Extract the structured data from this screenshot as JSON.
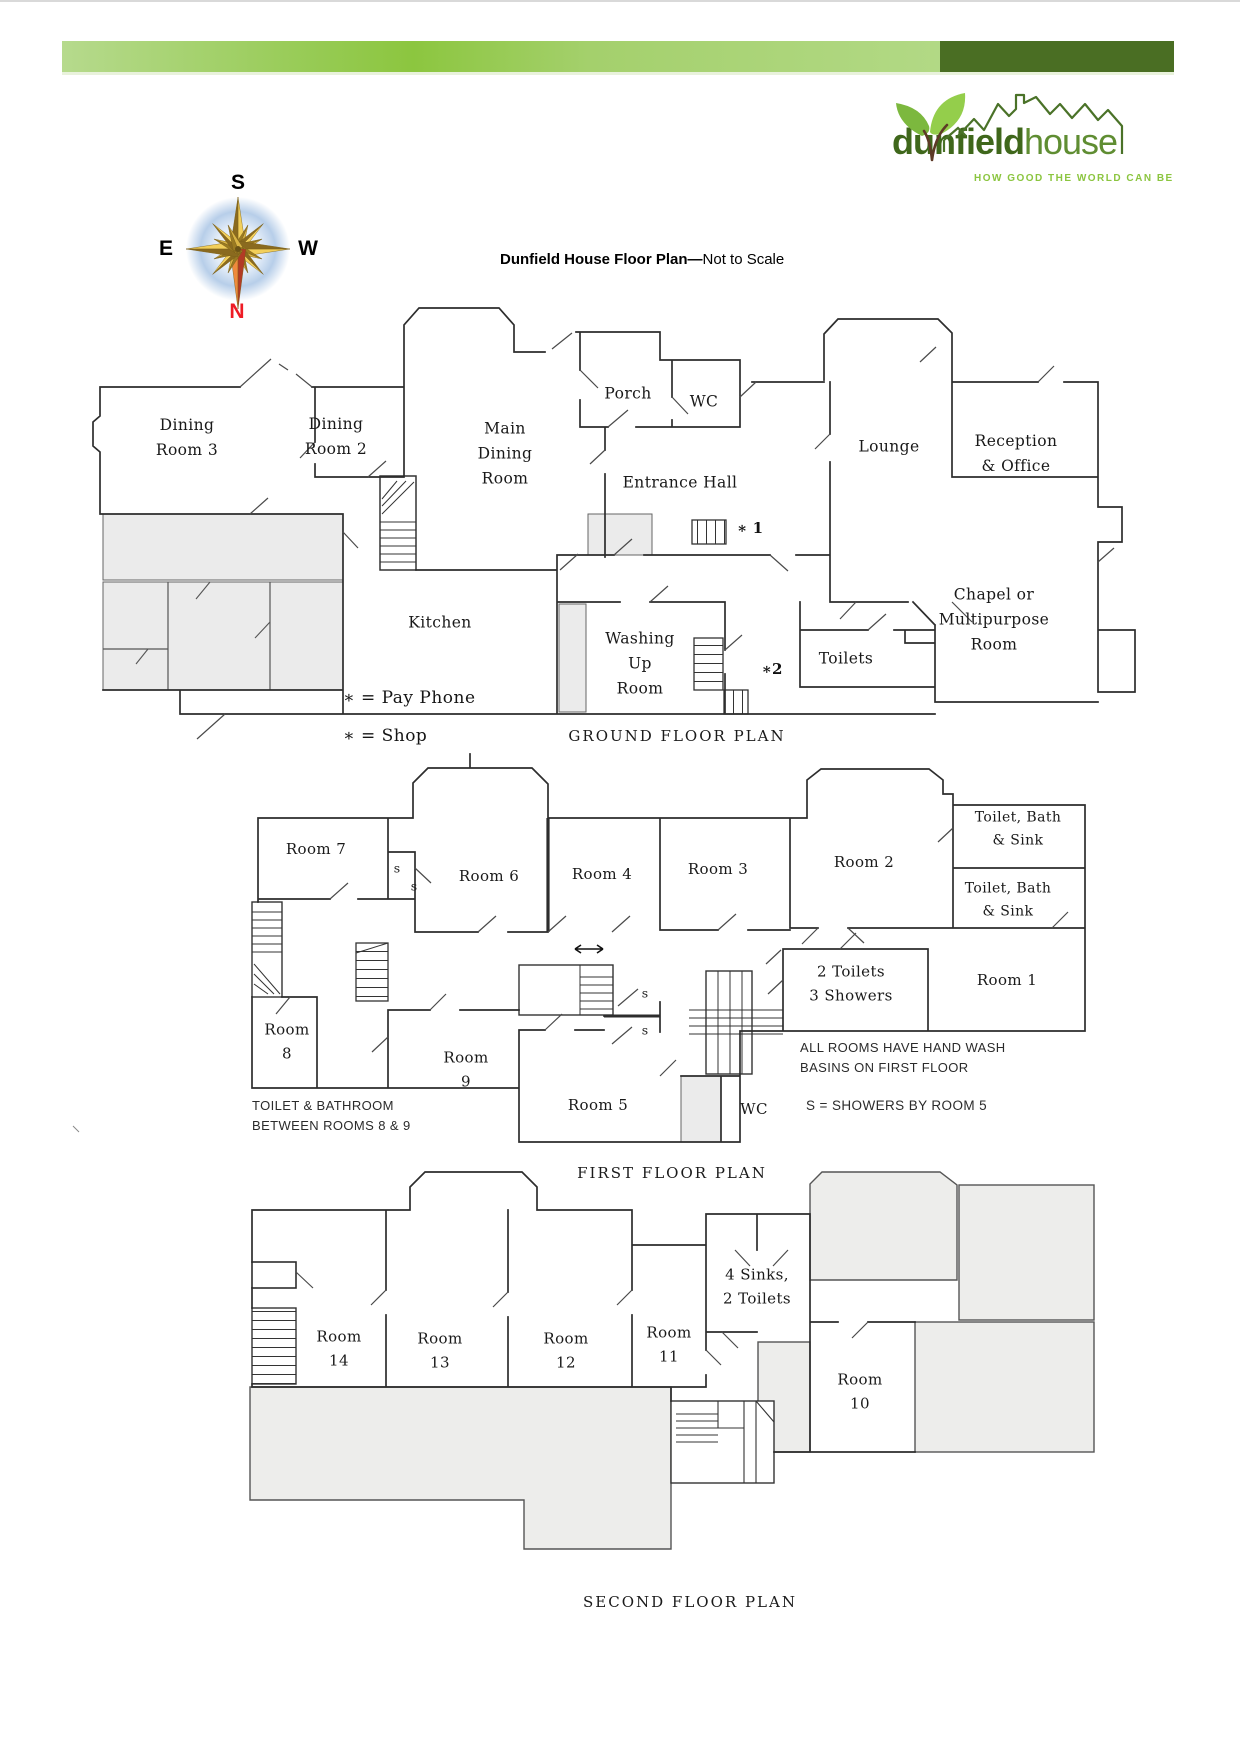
{
  "colors": {
    "accent_light": "#b6da8d",
    "accent_mid": "#8cc63f",
    "accent_dark": "#4a6e23",
    "north_red": "#ee1c25",
    "compass_gold": "#e3b53a"
  },
  "title": {
    "bold": "Dunfield House Floor Plan",
    "separator": "—",
    "regular": "Not to Scale"
  },
  "logo": {
    "brand_bold": "dunfield",
    "brand_light": "house",
    "tagline": "HOW GOOD THE WORLD CAN BE"
  },
  "compass": {
    "s": "S",
    "e": "E",
    "w": "W",
    "n": "N"
  },
  "ground_floor": {
    "caption": "GROUND FLOOR PLAN",
    "legend_pay_phone": "∗ = Pay Phone",
    "legend_shop": "∗ = Shop",
    "markers": {
      "pay_phone": "∗ 1",
      "shop": "∗2"
    },
    "rooms": {
      "dining3": "Dining\nRoom 3",
      "dining2": "Dining\nRoom 2",
      "main_dining": "Main\nDining\nRoom",
      "porch": "Porch",
      "wc": "WC",
      "entrance_hall": "Entrance Hall",
      "lounge": "Lounge",
      "reception": "Reception\n& Office",
      "chapel": "Chapel or\nMultipurpose\nRoom",
      "toilets": "Toilets",
      "washing_up": "Washing\nUp\nRoom",
      "kitchen": "Kitchen"
    }
  },
  "first_floor": {
    "caption": "FIRST FLOOR PLAN",
    "rooms": {
      "room7": "Room 7",
      "room6": "Room 6",
      "room4": "Room 4",
      "room3": "Room 3",
      "room2": "Room 2",
      "toilet_bath_top": "Toilet, Bath\n& Sink",
      "toilet_bath_mid": "Toilet, Bath\n& Sink",
      "room1": "Room 1",
      "toilets_showers": "2 Toilets\n3 Showers",
      "room8": "Room\n8",
      "room9": "Room\n9",
      "room5": "Room 5",
      "wc": "WC"
    },
    "shower_marks": {
      "a": "s",
      "b": "s",
      "c": "s",
      "d": "s"
    },
    "notes": {
      "toilet_bathroom": "TOILET & BATHROOM\nBETWEEN ROOMS 8 & 9",
      "hand_wash": "ALL ROOMS HAVE HAND WASH\nBASINS ON FIRST FLOOR",
      "showers": "S = SHOWERS BY ROOM 5"
    }
  },
  "second_floor": {
    "caption": "SECOND FLOOR PLAN",
    "rooms": {
      "room14": "Room\n14",
      "room13": "Room\n13",
      "room12": "Room\n12",
      "room11": "Room\n11",
      "sinks_toilets": "4 Sinks,\n2 Toilets",
      "room10": "Room\n10"
    }
  }
}
